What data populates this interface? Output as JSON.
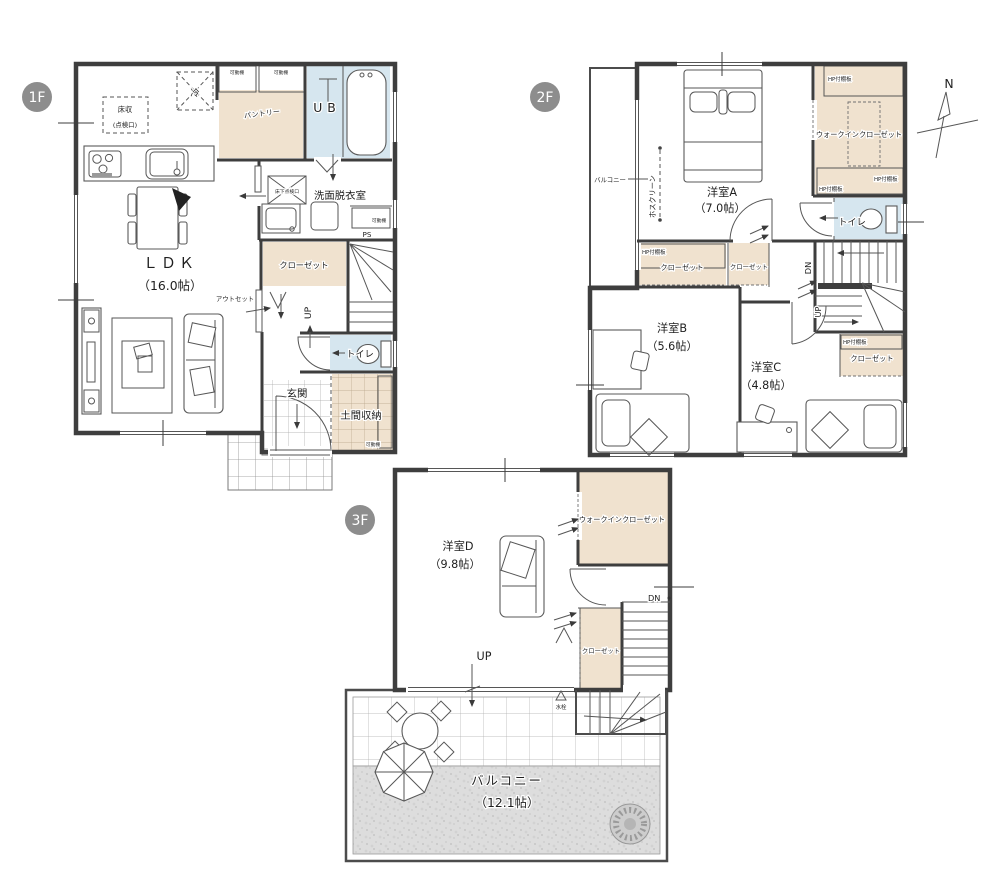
{
  "colors": {
    "wall": "#3e3e3e",
    "closet_beige": "#f0e2cf",
    "water_blue": "#d6e6ef",
    "badge_gray": "#8d8d8d",
    "gravel_gray": "#dddddd"
  },
  "shared": {
    "kadodana": "可動棚",
    "hp_shelf": "HP付棚板",
    "closet": "クローゼット",
    "wic": "ウォークインクローゼット",
    "toilet": "トイレ",
    "balcony": "バルコニー",
    "up": "UP",
    "dn": "DN"
  },
  "floor1": {
    "badge": "1F",
    "floor_storage": "床収",
    "floor_storage_sub": "(点検口)",
    "fridge": "冷",
    "pantry": "パントリー",
    "unit_bath": "UB",
    "washroom": "洗面脱衣室",
    "underfloor_hatch": "床下点検口",
    "pipe_space": "PS",
    "outset": "アウトセット",
    "ldk": "ＬＤＫ",
    "ldk_size": "（16.0帖）",
    "entrance": "玄関",
    "doma_storage": "土間収納"
  },
  "floor2": {
    "badge": "2F",
    "hoscreen": "ホスクリーン",
    "room_a": "洋室A",
    "room_a_size": "（7.0帖）",
    "room_b": "洋室B",
    "room_b_size": "（5.6帖）",
    "room_c": "洋室C",
    "room_c_size": "（4.8帖）"
  },
  "floor3": {
    "badge": "3F",
    "room_d": "洋室D",
    "room_d_size": "（9.8帖）",
    "faucet": "水栓",
    "balcony_size": "（12.1帖）"
  },
  "compass": {
    "north": "N"
  }
}
